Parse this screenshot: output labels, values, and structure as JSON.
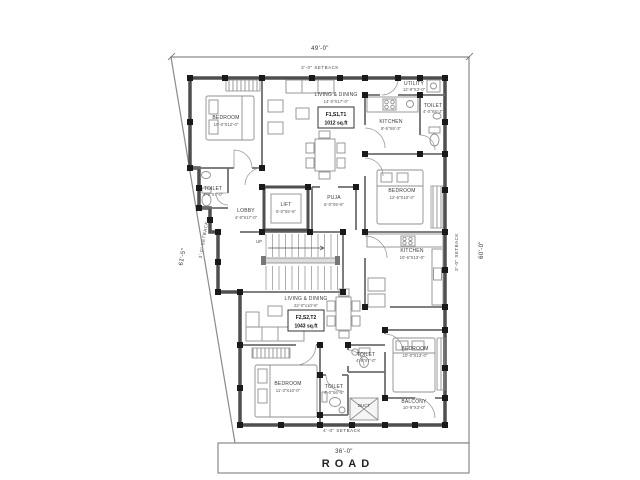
{
  "plan": {
    "dim_top": "49'-0\"",
    "dim_right": "60'-0\"",
    "dim_left": "61'-5\"",
    "dim_road": "36'-0\"",
    "road": "ROAD",
    "setback_top": "3'-0\" SETBACK",
    "setback_bottom": "4'-0\" SETBACK",
    "setback_left": "3'-0\" SETBACK",
    "setback_right": "3'-0\" SETBACK",
    "up": "UP",
    "duct": "DUCT",
    "flat1": {
      "code": "F1,S1,T1",
      "area": "1012 sq.ft"
    },
    "flat2": {
      "code": "F2,S2,T2",
      "area": "1043 sq.ft"
    },
    "rooms": {
      "bedroom1": {
        "name": "BEDROOM",
        "size": "10'-0\"X12'-0\""
      },
      "living1": {
        "name": "LIVING & DINING",
        "size": "14'-0\"X17'-0\""
      },
      "utility": {
        "name": "UTILITY",
        "size": "12'-9\"X3'-0\""
      },
      "kitchen1": {
        "name": "KITCHEN",
        "size": "8'-6\"X8'-3\""
      },
      "toilet1r": {
        "name": "TOILET",
        "size": "4'-0\"X8'-2\""
      },
      "toilet1l": {
        "name": "TOILET",
        "size": "4'-0\"X7'-0\""
      },
      "lobby": {
        "name": "LOBBY",
        "size": "4'-9\"X17'-0\""
      },
      "lift": {
        "name": "LIFT",
        "size": "5'-0\"X5'-6\""
      },
      "puja": {
        "name": "PUJA",
        "size": "6'-0\"X5'-6\""
      },
      "bedroom2": {
        "name": "BEDROOM",
        "size": "12'-6\"X10'-0\""
      },
      "kitchen2": {
        "name": "KITCHEN",
        "size": "10'-6\"X13'-9\""
      },
      "living2": {
        "name": "LIVING & DINING",
        "size": "22'-0\"x10'-6\""
      },
      "bedroom3": {
        "name": "BEDROOM",
        "size": "11'-3\"X10'-0\""
      },
      "toilet2a": {
        "name": "TOILET",
        "size": "4'-6\"X7'-0\""
      },
      "toilet2b": {
        "name": "TOILET",
        "size": "4'-0\"X6'-9\""
      },
      "bedroom4": {
        "name": "BEDROOM",
        "size": "10'-0\"X13'-0\""
      },
      "balcony": {
        "name": "BALCONY",
        "size": "10'-9\"X3'-0\""
      }
    }
  }
}
